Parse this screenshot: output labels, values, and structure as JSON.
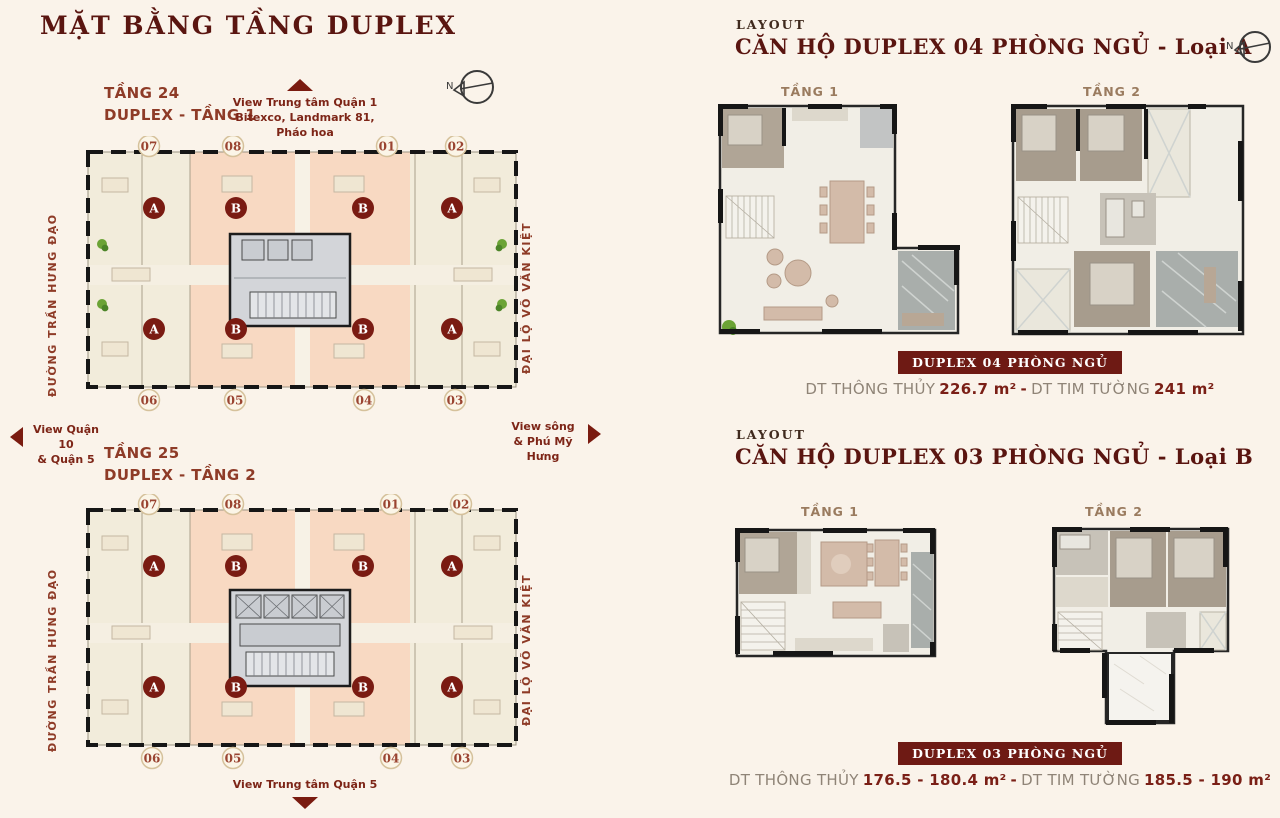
{
  "page_title": "MẶT BẰNG TẦNG DUPLEX",
  "compass": {
    "label": "N"
  },
  "sections": {
    "floor24": "TẦNG 24\nDUPLEX - TẦNG 1",
    "floor25": "TẦNG 25\nDUPLEX - TẦNG 2"
  },
  "views": {
    "top": "View Trung tâm Quận 1\nBitexco, Landmark 81,\nPháo hoa",
    "left": "View Quận 10\n& Quận 5",
    "right": "View sông\n& Phú Mỹ Hưng",
    "bottom": "View Trung tâm Quận 5"
  },
  "tower": {
    "street_left": "ĐƯỜNG TRẦN HƯNG ĐẠO",
    "street_right": "ĐẠI LỘ VÕ VĂN KIỆT",
    "numbers_top": [
      "07",
      "08",
      "01",
      "02"
    ],
    "numbers_bottom": [
      "06",
      "05",
      "04",
      "03"
    ],
    "badges_top": [
      "A",
      "B",
      "B",
      "A"
    ],
    "badges_bottom": [
      "A",
      "B",
      "B",
      "A"
    ]
  },
  "layout_a": {
    "eyebrow": "LAYOUT",
    "title": "CĂN HỘ DUPLEX 04 PHÒNG NGỦ - Loại A",
    "floor1": "TẦNG 1",
    "floor2": "TẦNG 2",
    "badge": "DUPLEX 04 PHÒNG NGỦ",
    "area_label1": "DT THÔNG THỦY",
    "area_value1": "226.7 m²",
    "area_sep": "-",
    "area_label2": "DT TIM TƯỜNG",
    "area_value2": "241 m²"
  },
  "layout_b": {
    "eyebrow": "LAYOUT",
    "title": "CĂN HỘ DUPLEX 03 PHÒNG NGỦ - Loại B",
    "floor1": "TẦNG 1",
    "floor2": "TẦNG 2",
    "badge": "DUPLEX 03 PHÒNG NGỦ",
    "area_label1": "DT THÔNG THỦY",
    "area_value1": "176.5 - 180.4 m²",
    "area_sep": "-",
    "area_label2": "DT TIM TƯỜNG",
    "area_value2": "185.5 - 190 m²"
  },
  "colors": {
    "background": "#faf3ea",
    "maroon": "#5a1510",
    "brick": "#8e3b27",
    "badge_bg": "#6e1a14",
    "unit_cream": "#f2ecdb",
    "unit_peach": "#f8d9c2",
    "core_gray": "#d3d5d9"
  }
}
